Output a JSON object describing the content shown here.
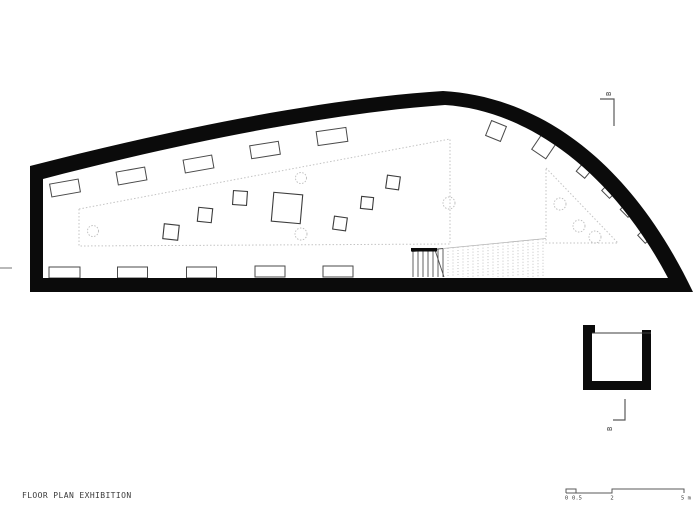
{
  "meta": {
    "title": "FLOOR PLAN EXHIBITION",
    "drawing_type": "architectural floor plan"
  },
  "colors": {
    "wall": "#0b0b0b",
    "case_line": "#4a4a4a",
    "pedestal_line": "#3c3c3c",
    "dash_line": "#c3c3c3",
    "circle_line": "#bcbcbc",
    "stair_dark": "#4f4f4f",
    "stair_light": "#b5b5b5",
    "marker_line": "#5a5a5a",
    "text": "#3a3a3a",
    "bg": "#ffffff"
  },
  "plan": {
    "wall_path": "M30,166 C170,130 320,99 443,91 C530,96 625,150 693,292 L30,292 Z M43,179 C180,143 330,113 445,105 C525,110 610,168 668,278 L43,278 Z",
    "dashed_regions": [
      "79,209 450,139 450,244 79,246",
      "546,168 618,243 546,243"
    ],
    "dashed_circles": [
      [
        93,
        231,
        5.5
      ],
      [
        301,
        178,
        5.5
      ],
      [
        301,
        234,
        6
      ],
      [
        449,
        203,
        6
      ],
      [
        560,
        204,
        6
      ],
      [
        579,
        226,
        6
      ],
      [
        595,
        237,
        6
      ]
    ],
    "top_cases": [
      [
        65,
        188,
        29,
        13,
        -10
      ],
      [
        131.5,
        176,
        29,
        13,
        -10
      ],
      [
        198.5,
        164,
        29,
        13,
        -10
      ],
      [
        265,
        150,
        29,
        13,
        -9
      ],
      [
        332,
        136.5,
        30,
        14,
        -8
      ]
    ],
    "bottom_cases": [
      [
        64.5,
        272.5,
        31,
        11
      ],
      [
        132.5,
        272.5,
        30,
        11
      ],
      [
        201.5,
        272.5,
        30,
        11
      ],
      [
        270,
        271.5,
        30,
        11
      ],
      [
        338,
        271.5,
        30,
        11
      ]
    ],
    "pedestals": [
      [
        171,
        232,
        15,
        6
      ],
      [
        205,
        215,
        14,
        6
      ],
      [
        240,
        198,
        14,
        4
      ],
      [
        287,
        208,
        29,
        5
      ],
      [
        340,
        223.5,
        13,
        8
      ],
      [
        367,
        203,
        12,
        6
      ],
      [
        393,
        182.5,
        13,
        8
      ]
    ],
    "curve_cases": [
      [
        496,
        131,
        16,
        22
      ],
      [
        543.5,
        147,
        17,
        34
      ],
      [
        584,
        170.5,
        11,
        40
      ],
      [
        609.5,
        190.5,
        11,
        45
      ],
      [
        628,
        209.5,
        11,
        45
      ],
      [
        645.5,
        235.5,
        11,
        47
      ]
    ],
    "stair": {
      "x_start": 412,
      "x_break": 443,
      "x_end": 546,
      "step": 5,
      "y_top_start": 251.5,
      "y_top_break": 248.5,
      "y_top_end": 238.5,
      "y_bottom": 277,
      "rail": [
        411,
        248,
        26,
        3.5
      ],
      "break_line": [
        435,
        250,
        444,
        277
      ]
    },
    "edge_tick": [
      0,
      268,
      12,
      268
    ],
    "section_markers": [
      {
        "label": "B",
        "line": "600,99 614,99 614,126",
        "text_pos": [
          611,
          96
        ]
      },
      {
        "label": "B",
        "line": "625,399 625,420 613,420",
        "text_pos": [
          612,
          431
        ]
      }
    ],
    "shaft": {
      "rects": [
        [
          583,
          325,
          12,
          8
        ],
        [
          583,
          326,
          9,
          64
        ],
        [
          642,
          330,
          9,
          60
        ],
        [
          583,
          381,
          68,
          9
        ]
      ],
      "top_line": [
        592,
        333,
        651,
        333
      ]
    }
  },
  "scale_bar": {
    "path": "M566,493 L566,489 L576,489 L576,493 L566,493 M576,493 L612,493 L612,489 L684,489 L684,493",
    "ticks": [
      {
        "label": "0",
        "x": 566.5
      },
      {
        "label": "0.5",
        "x": 577
      },
      {
        "label": "2",
        "x": 612
      },
      {
        "label": "5 m",
        "x": 686
      }
    ],
    "label_y": 499.5
  }
}
